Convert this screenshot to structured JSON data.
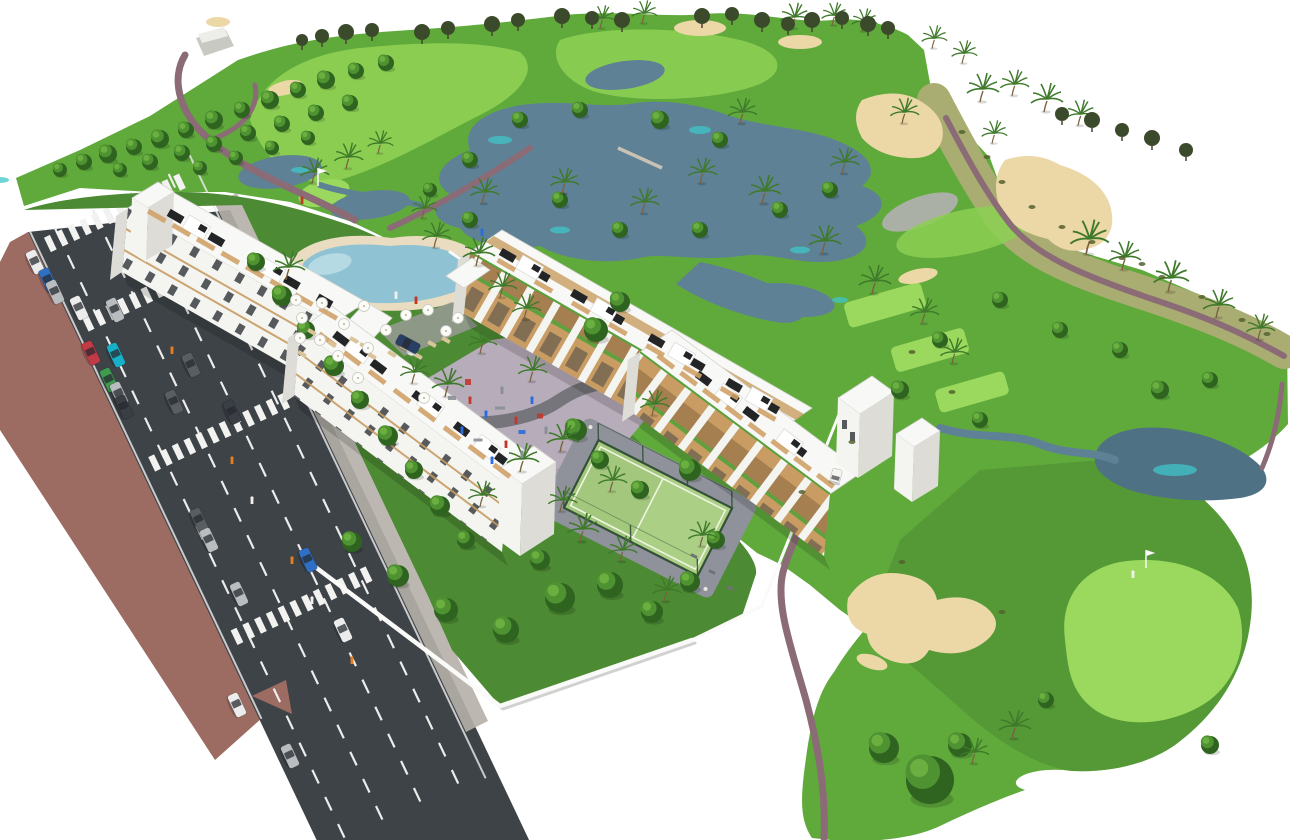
{
  "palette": {
    "bg": "#ffffff",
    "greenBase": "#60aa3c",
    "greenGarden": "#4c8a33",
    "greenLight": "#8ccf52",
    "greenLighter": "#9bd95e",
    "dryGrass": "#a9ad72",
    "grayPatch": "#aab0a6",
    "treeDark": "#2f6320",
    "treeMid": "#4e9231",
    "treeLight": "#6fb244",
    "treeOlive": "#3c4a2c",
    "palm": "#3f7a2b",
    "scrubCol": "#55622f",
    "trunk": "#7a6140",
    "water": "#5e8195",
    "waterDark": "#4e7184",
    "waterTeal": "#40c6c9",
    "sand": "#ecd8a6",
    "path": "#8a6b76",
    "pathGray": "#9a9a96",
    "road": "#3e4347",
    "sidewalk": "#9c6b62",
    "sidewalkLight": "#b5b0a9",
    "line": "#ececec",
    "wall": "#fafaf8",
    "roof": "#f8f8f6",
    "facade": "#f4f4f1",
    "facadeShade": "#dddcd7",
    "balconyTan": "#c89c62",
    "deckTan": "#cfa268",
    "windowDark": "#2e3338",
    "panelDark": "#222426",
    "hedge": "#56a13b",
    "plaza": "#b7acb9",
    "plazaPath": "#6f6f74",
    "poolDeck": "#e9dcc0",
    "poolWater": "#8fc2d3",
    "poolLight": "#bfe0e8",
    "padelCourt": "#accf86",
    "padelFence": "#34503a",
    "padelApron": "#8f929a",
    "carWhite": "#ececec",
    "carSilver": "#b9bdc0",
    "carGray": "#595e63",
    "carDark": "#3a3f45",
    "carBlue": "#2f6fc4",
    "carTeal": "#18b0c8",
    "carRed": "#c23a46",
    "carGreen": "#3f9b4f",
    "carNavy": "#2a3f66",
    "personRed": "#c0392b",
    "personBlue": "#2d6cdf",
    "personGray": "#8a8f96",
    "personWhite": "#f0f0ec",
    "personOrange": "#e67e22"
  },
  "scene": {
    "road": {
      "origin": [
        28,
        232
      ],
      "dir": [
        0.429,
        0.903
      ],
      "angle_deg": 64.6,
      "length": 690,
      "crosswalks": [
        20,
        108,
        263,
        455
      ],
      "lane_lines": [
        26,
        68,
        110,
        152
      ]
    },
    "cars": [
      [
        35,
        262,
        "carWhite"
      ],
      [
        48,
        280,
        "carBlue"
      ],
      [
        55,
        292,
        "carSilver"
      ],
      [
        79,
        308,
        "carWhite"
      ],
      [
        115,
        310,
        "carSilver"
      ],
      [
        91,
        353,
        "carRed"
      ],
      [
        116,
        355,
        "carTeal"
      ],
      [
        109,
        380,
        "carGreen"
      ],
      [
        119,
        394,
        "carSilver"
      ],
      [
        124,
        407,
        "carDark"
      ],
      [
        191,
        365,
        "carGray"
      ],
      [
        174,
        402,
        "carGray"
      ],
      [
        232,
        412,
        "carDark"
      ],
      [
        199,
        520,
        "carGray"
      ],
      [
        209,
        540,
        "carSilver"
      ],
      [
        239,
        594,
        "carSilver"
      ],
      [
        308,
        560,
        "carBlue"
      ],
      [
        343,
        630,
        "carWhite"
      ],
      [
        237,
        705,
        "carWhite"
      ],
      [
        290,
        756,
        "carSilver"
      ],
      [
        408,
        344,
        "carNavy"
      ]
    ],
    "trees_round": [
      [
        60,
        170,
        7
      ],
      [
        84,
        162,
        8
      ],
      [
        108,
        154,
        9
      ],
      [
        134,
        147,
        8
      ],
      [
        160,
        139,
        9
      ],
      [
        186,
        130,
        8
      ],
      [
        214,
        120,
        9
      ],
      [
        242,
        110,
        8
      ],
      [
        270,
        100,
        9
      ],
      [
        298,
        90,
        8
      ],
      [
        326,
        80,
        9
      ],
      [
        356,
        71,
        8
      ],
      [
        386,
        63,
        8
      ],
      [
        120,
        170,
        7
      ],
      [
        150,
        162,
        8
      ],
      [
        182,
        153,
        8
      ],
      [
        214,
        144,
        8
      ],
      [
        248,
        133,
        8
      ],
      [
        282,
        124,
        8
      ],
      [
        316,
        113,
        8
      ],
      [
        350,
        103,
        8
      ],
      [
        200,
        168,
        7
      ],
      [
        236,
        158,
        7
      ],
      [
        272,
        148,
        7
      ],
      [
        308,
        138,
        7
      ],
      [
        470,
        160,
        8
      ],
      [
        520,
        120,
        8
      ],
      [
        580,
        110,
        8
      ],
      [
        660,
        120,
        9
      ],
      [
        720,
        140,
        8
      ],
      [
        560,
        200,
        8
      ],
      [
        620,
        230,
        8
      ],
      [
        700,
        230,
        8
      ],
      [
        780,
        210,
        8
      ],
      [
        830,
        190,
        8
      ],
      [
        470,
        220,
        8
      ],
      [
        430,
        190,
        7
      ],
      [
        1000,
        300,
        8
      ],
      [
        1060,
        330,
        8
      ],
      [
        940,
        340,
        8
      ],
      [
        900,
        390,
        9
      ],
      [
        980,
        420,
        8
      ],
      [
        1160,
        390,
        9
      ],
      [
        1210,
        380,
        8
      ],
      [
        1120,
        350,
        8
      ],
      [
        930,
        780,
        24
      ],
      [
        884,
        748,
        15
      ],
      [
        960,
        745,
        12
      ],
      [
        1046,
        700,
        8
      ],
      [
        1210,
        745,
        9
      ],
      [
        256,
        262,
        9
      ],
      [
        282,
        296,
        10
      ],
      [
        306,
        330,
        9
      ],
      [
        334,
        366,
        10
      ],
      [
        360,
        400,
        9
      ],
      [
        388,
        436,
        10
      ],
      [
        414,
        470,
        9
      ],
      [
        440,
        506,
        10
      ],
      [
        466,
        540,
        9
      ],
      [
        560,
        598,
        15
      ],
      [
        610,
        585,
        13
      ],
      [
        652,
        612,
        11
      ],
      [
        506,
        630,
        13
      ],
      [
        446,
        610,
        12
      ],
      [
        398,
        576,
        11
      ],
      [
        352,
        542,
        10
      ],
      [
        690,
        582,
        10
      ],
      [
        716,
        540,
        9
      ],
      [
        690,
        470,
        11
      ],
      [
        596,
        330,
        12
      ],
      [
        620,
        302,
        10
      ],
      [
        576,
        430,
        11
      ],
      [
        540,
        560,
        10
      ],
      [
        600,
        460,
        9
      ],
      [
        640,
        490,
        9
      ]
    ],
    "trees_palm": [
      [
        286,
        278,
        1
      ],
      [
        476,
        264,
        1
      ],
      [
        500,
        296,
        0.9
      ],
      [
        434,
        246,
        0.9
      ],
      [
        524,
        318,
        0.9
      ],
      [
        530,
        380,
        0.9
      ],
      [
        480,
        352,
        0.9
      ],
      [
        445,
        395,
        1
      ],
      [
        560,
        450,
        1
      ],
      [
        610,
        490,
        0.9
      ],
      [
        520,
        470,
        1
      ],
      [
        480,
        505,
        0.9
      ],
      [
        580,
        540,
        1
      ],
      [
        620,
        560,
        0.9
      ],
      [
        700,
        545,
        0.9
      ],
      [
        560,
        510,
        0.9
      ],
      [
        664,
        600,
        0.9
      ],
      [
        1086,
        252,
        1.2
      ],
      [
        1122,
        268,
        1
      ],
      [
        1168,
        290,
        1.1
      ],
      [
        1216,
        316,
        1
      ],
      [
        1258,
        338,
        0.9
      ],
      [
        980,
        100,
        1
      ],
      [
        1012,
        94,
        0.9
      ],
      [
        1044,
        110,
        1
      ],
      [
        1078,
        124,
        0.9
      ],
      [
        992,
        142,
        0.8
      ],
      [
        740,
        122,
        0.9
      ],
      [
        700,
        182,
        0.9
      ],
      [
        762,
        202,
        1
      ],
      [
        642,
        212,
        0.9
      ],
      [
        562,
        192,
        0.9
      ],
      [
        482,
        202,
        0.9
      ],
      [
        422,
        217,
        0.8
      ],
      [
        822,
        252,
        1
      ],
      [
        872,
        292,
        1
      ],
      [
        922,
        322,
        0.9
      ],
      [
        952,
        362,
        0.9
      ],
      [
        842,
        172,
        0.9
      ],
      [
        902,
        122,
        0.9
      ],
      [
        312,
        182,
        0.9
      ],
      [
        346,
        167,
        0.9
      ],
      [
        378,
        152,
        0.8
      ],
      [
        600,
        27,
        0.8
      ],
      [
        642,
        22,
        0.8
      ],
      [
        792,
        27,
        0.9
      ],
      [
        832,
        24,
        0.8
      ],
      [
        862,
        30,
        0.8
      ],
      [
        932,
        47,
        0.8
      ],
      [
        962,
        62,
        0.8
      ],
      [
        1012,
        737,
        1
      ],
      [
        972,
        762,
        0.9
      ],
      [
        412,
        382,
        0.9
      ],
      [
        652,
        414,
        0.9
      ]
    ],
    "trees_horizon": [
      [
        302,
        40,
        6
      ],
      [
        322,
        36,
        7
      ],
      [
        346,
        32,
        8
      ],
      [
        372,
        30,
        7
      ],
      [
        422,
        32,
        8
      ],
      [
        448,
        28,
        7
      ],
      [
        492,
        24,
        8
      ],
      [
        518,
        20,
        7
      ],
      [
        562,
        16,
        8
      ],
      [
        592,
        18,
        7
      ],
      [
        622,
        20,
        8
      ],
      [
        702,
        16,
        8
      ],
      [
        732,
        14,
        7
      ],
      [
        762,
        20,
        8
      ],
      [
        788,
        24,
        7
      ],
      [
        812,
        20,
        8
      ],
      [
        842,
        18,
        7
      ],
      [
        868,
        24,
        8
      ],
      [
        888,
        28,
        7
      ],
      [
        1062,
        114,
        7
      ],
      [
        1092,
        120,
        8
      ],
      [
        1122,
        130,
        7
      ],
      [
        1152,
        138,
        8
      ],
      [
        1186,
        150,
        7
      ]
    ],
    "scrub": [
      [
        1002,
        182
      ],
      [
        1032,
        207
      ],
      [
        1062,
        227
      ],
      [
        1092,
        242
      ],
      [
        1122,
        258
      ],
      [
        1162,
        277
      ],
      [
        1202,
        297
      ],
      [
        1242,
        320
      ],
      [
        962,
        132
      ],
      [
        987,
        157
      ],
      [
        1267,
        334
      ],
      [
        1142,
        264
      ],
      [
        912,
        352
      ],
      [
        952,
        392
      ],
      [
        852,
        442
      ],
      [
        802,
        492
      ],
      [
        902,
        562
      ],
      [
        1002,
        612
      ]
    ],
    "umbrellas": [
      [
        302,
        318
      ],
      [
        322,
        303
      ],
      [
        344,
        324
      ],
      [
        364,
        306
      ],
      [
        386,
        330
      ],
      [
        406,
        315
      ],
      [
        300,
        338
      ],
      [
        428,
        310
      ],
      [
        446,
        331
      ],
      [
        368,
        348
      ],
      [
        338,
        356
      ],
      [
        412,
        350
      ],
      [
        296,
        300
      ],
      [
        458,
        318
      ],
      [
        320,
        340
      ],
      [
        358,
        378
      ],
      [
        424,
        398
      ]
    ],
    "loungers": [
      [
        312,
        332
      ],
      [
        322,
        338
      ],
      [
        332,
        344
      ],
      [
        354,
        340
      ],
      [
        364,
        346
      ],
      [
        302,
        354
      ],
      [
        392,
        354
      ],
      [
        404,
        348
      ],
      [
        432,
        344
      ],
      [
        446,
        340
      ],
      [
        372,
        356
      ],
      [
        418,
        356
      ]
    ],
    "people": [
      [
        470,
        402,
        "personRed"
      ],
      [
        486,
        416,
        "personBlue"
      ],
      [
        502,
        392,
        "personGray"
      ],
      [
        516,
        422,
        "personRed"
      ],
      [
        532,
        402,
        "personBlue"
      ],
      [
        546,
        432,
        "personGray"
      ],
      [
        462,
        432,
        "personBlue"
      ],
      [
        506,
        446,
        "personRed"
      ],
      [
        522,
        456,
        "personGray"
      ],
      [
        492,
        462,
        "personBlue"
      ],
      [
        172,
        352,
        "personOrange"
      ],
      [
        188,
        366,
        "personWhite"
      ],
      [
        232,
        462,
        "personOrange"
      ],
      [
        252,
        502,
        "personWhite"
      ],
      [
        292,
        562,
        "personOrange"
      ],
      [
        312,
        602,
        "personWhite"
      ],
      [
        352,
        662,
        "personOrange"
      ],
      [
        396,
        297,
        "personWhite"
      ],
      [
        416,
        302,
        "personRed"
      ],
      [
        1133,
        576,
        "personWhite"
      ],
      [
        302,
        202,
        "personRed"
      ],
      [
        482,
        234,
        "personBlue"
      ]
    ],
    "play_equipment": [
      [
        452,
        398,
        8,
        4,
        "personGray"
      ],
      [
        468,
        382,
        6,
        6,
        "personRed"
      ],
      [
        500,
        408,
        10,
        3,
        "personGray"
      ],
      [
        522,
        432,
        7,
        4,
        "personBlue"
      ],
      [
        540,
        416,
        6,
        5,
        "personRed"
      ],
      [
        478,
        440,
        9,
        3,
        "personGray"
      ]
    ],
    "roof_axes": {
      "L1": {
        "s": [
          145,
          199
        ],
        "e": [
          349,
          315
        ],
        "ang": 30
      },
      "L2": {
        "s": [
          316,
          320
        ],
        "e": [
          524,
          476
        ],
        "ang": 37
      },
      "R1": {
        "s": [
          486,
          243
        ],
        "e": [
          796,
          421
        ],
        "ang": 30
      },
      "R2": {
        "s": [
          656,
          343
        ],
        "e": [
          846,
          485
        ],
        "ang": 37
      }
    },
    "roof_panels": {
      "L1": [
        0.15,
        0.35,
        0.55,
        0.72,
        0.88
      ],
      "L2": [
        0.12,
        0.3,
        0.5,
        0.7,
        0.88
      ],
      "R1": [
        0.07,
        0.18,
        0.3,
        0.42,
        0.55,
        0.68,
        0.8,
        0.92
      ],
      "R2": [
        0.25,
        0.5,
        0.75
      ]
    },
    "roof_boxes": {
      "L1": [
        0.25,
        0.62
      ],
      "L2": [
        0.2,
        0.55,
        0.82
      ],
      "R1": [
        0.14,
        0.38,
        0.63,
        0.88
      ],
      "R2": [
        0.38,
        0.7
      ]
    },
    "roof_deck_step": 0.12,
    "flags": [
      [
        1146,
        568
      ],
      [
        318,
        186
      ]
    ],
    "cart": [
      836,
      476,
      15
    ],
    "benches": [
      [
        694,
        556
      ],
      [
        712,
        572
      ],
      [
        730,
        588
      ]
    ]
  }
}
